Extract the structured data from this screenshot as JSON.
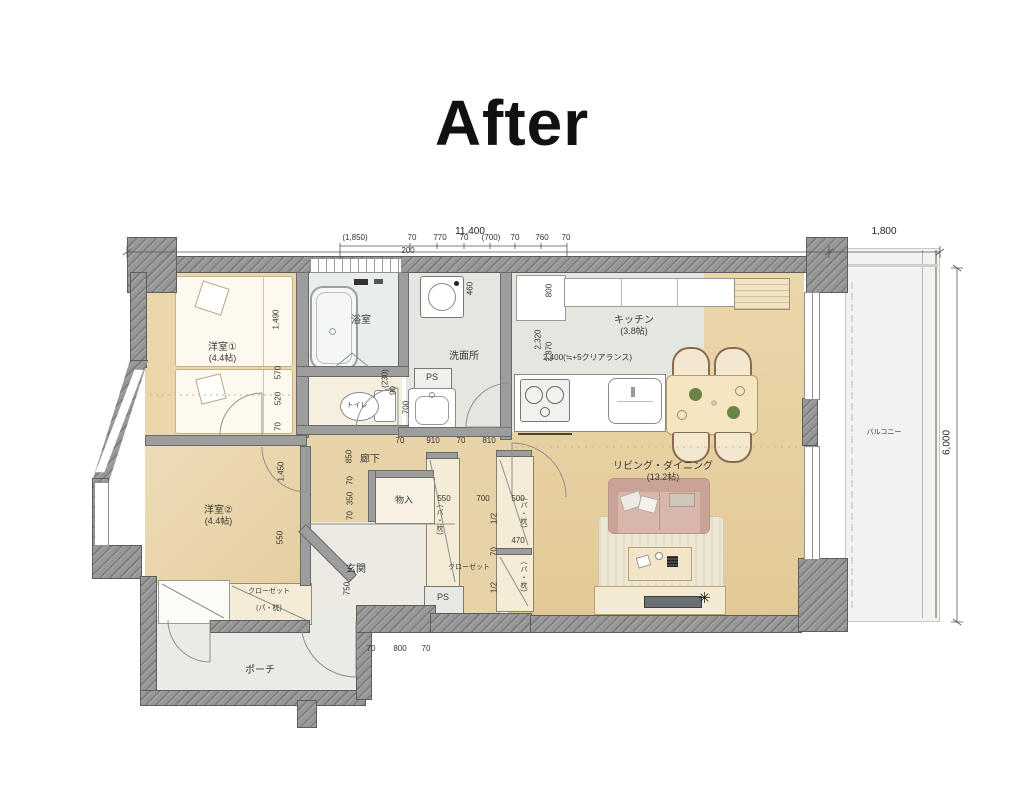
{
  "title": "After",
  "dims": {
    "w_total": "11,400",
    "w_balcony": "1,800",
    "h_total": "6,000",
    "sub": [
      "(1,850)",
      "200",
      "70",
      "770",
      "70",
      "(700)",
      "70",
      "760",
      "70"
    ],
    "hall_row": [
      "70",
      "910",
      "70",
      "810"
    ],
    "closet_row": [
      "550",
      "700",
      "500"
    ],
    "closet_mid": "470",
    "half": "1/2",
    "small70": "70",
    "porch_row": [
      "70",
      "800",
      "70"
    ],
    "left_col": [
      "1,490",
      "570",
      "520",
      "70",
      "1,450",
      "550"
    ],
    "hall_col": [
      "850",
      "70",
      "350",
      "70"
    ],
    "entr_750": "750",
    "toilet_col": [
      "(230)",
      "90",
      "700"
    ],
    "kit_col": [
      "460",
      "800",
      "2,320",
      "2,870"
    ],
    "clearance": "2,400(≒+5クリアランス)"
  },
  "rooms": {
    "bedroom1": "洋室①",
    "bedroom1_size": "(4.4帖)",
    "bedroom2": "洋室②",
    "bedroom2_size": "(4.4帖)",
    "bath": "浴室",
    "washroom": "洗面所",
    "toilet": "トイレ",
    "kitchen": "キッチン",
    "kitchen_size": "(3.8帖)",
    "living": "リビング・ダイニング",
    "living_size": "(13.2帖)",
    "hallway": "廊下",
    "storage": "物入",
    "entrance": "玄関",
    "closet": "クローゼット",
    "shelf_note": "(パ・枕)",
    "porch": "ポーチ",
    "balcony": "バルコニー",
    "ps": "PS"
  },
  "decor": {
    "star": "✳"
  },
  "colors": {
    "wall": "#979797",
    "wood_floor": "#ead6aa",
    "ld_floor": "#e8d1a0",
    "tile": "#e3e7df",
    "bath": "#e9edec",
    "balcony": "#f2f3f0",
    "sofa": "#d9b6ab",
    "closet_cream": "#f4ecd6"
  }
}
